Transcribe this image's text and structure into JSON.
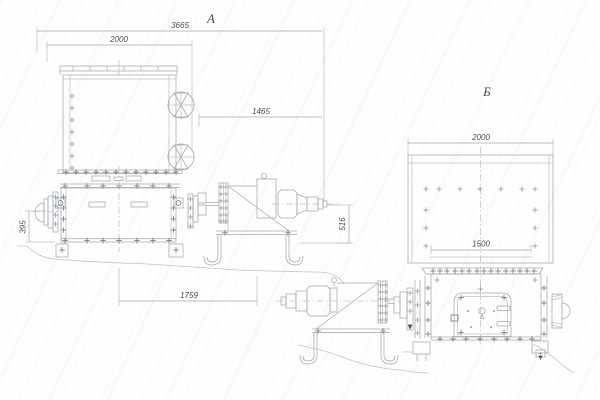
{
  "drawing": {
    "view_a": {
      "label": "А",
      "dim_overall": "3665",
      "dim_hopper": "2000",
      "dim_drive": "1465",
      "dim_height": "516",
      "dim_shaft": "395",
      "dim_base": "1759"
    },
    "view_b": {
      "label": "Б",
      "dim_hopper": "2000",
      "dim_inner": "1500"
    },
    "colors": {
      "line_light": "#bdc2c7",
      "line_medium": "#a2a8ae",
      "line_dark": "#676d73",
      "text": "#474c52",
      "background": "#fefefe"
    }
  }
}
